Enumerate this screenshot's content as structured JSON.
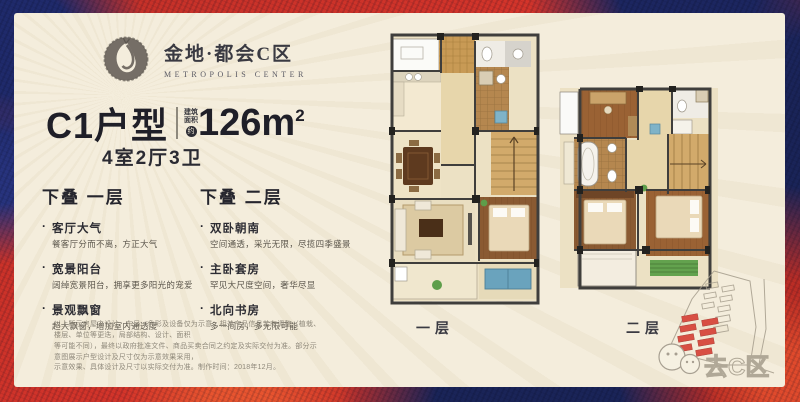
{
  "brand": {
    "name": "金地·都会C区",
    "subtitle": "METROPOLIS CENTER"
  },
  "headline": {
    "model": "C1户型",
    "area_label_top": "建筑",
    "area_label_bottom": "面积",
    "area_approx": "约",
    "area_value": "126m",
    "area_sup": "2",
    "layout": "4室2厅3卫"
  },
  "sections": [
    {
      "title": "下叠 一层",
      "items": [
        {
          "title": "客厅大气",
          "desc": "餐客厅分而不离，方正大气"
        },
        {
          "title": "宽景阳台",
          "desc": "阔绰宽景阳台，拥享更多阳光的宠爱"
        },
        {
          "title": "景观飘窗",
          "desc": "超大飘窗，增加室内通透度"
        }
      ]
    },
    {
      "title": "下叠 二层",
      "items": [
        {
          "title": "双卧朝南",
          "desc": "空间通透，采光无限，尽揽四季盛景"
        },
        {
          "title": "主卧套房",
          "desc": "罕见大尺度空间，奢华尽显"
        },
        {
          "title": "北向书房",
          "desc": "多一间房，多无限可能"
        }
      ]
    }
  ],
  "plans": [
    {
      "label": "一层"
    },
    {
      "label": "二层"
    }
  ],
  "disclaimer": {
    "lines": [
      "以上所示房屋之设计、布局、色彩及设备仅为示意，相关产品信息若有调整（植栽、楼层、单位等更迭，局部结构、设计、面积",
      "等可能不同），最终以政府批准文件、商品买卖合同之约定及实际交付为准。部分示意图展示户型设计及尺寸仅为示意效果采用，",
      "示意效果、具体设计及尺寸以实际交付为准。制作时间：2018年12月。"
    ]
  },
  "watermark": {
    "text": "去C区"
  },
  "colors": {
    "panel": "#f4eddc",
    "ink": "#26262e",
    "accent_red": "#d4342a",
    "accent_navy": "#1f2a66"
  }
}
